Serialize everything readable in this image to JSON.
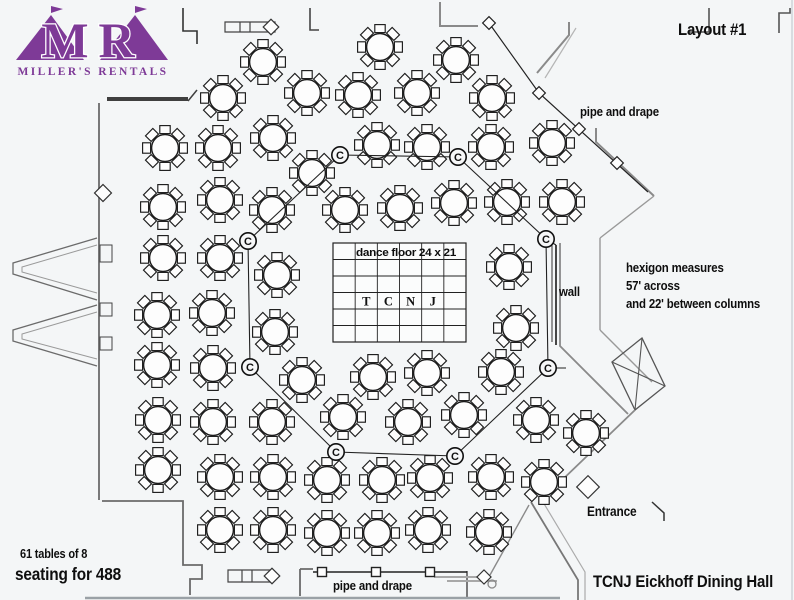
{
  "logo": {
    "monogram": "MR",
    "name": "MILLER'S RENTALS",
    "color": "#7e3a97"
  },
  "labels": {
    "layout_title": "Layout #1",
    "pipe_drape_top": "pipe and drape",
    "pipe_drape_bottom": "pipe and drape",
    "hexagon_note": "hexigon measures\n57' across\nand 22' between columns",
    "wall_label": "wall",
    "entrance_label": "Entrance",
    "tables_note_line1": "61 tables of 8",
    "tables_note_line2": "seating for 488",
    "hall_title": "TCNJ Eickhoff Dining Hall"
  },
  "dance_floor": {
    "label": "dance floor 24 x 21",
    "letters": [
      "T",
      "C",
      "N",
      "J"
    ],
    "x": 333,
    "y": 243,
    "w": 133,
    "h": 99,
    "cols": 6,
    "rows": 6
  },
  "octagon": {
    "marker": "C",
    "vertices": [
      [
        340,
        155
      ],
      [
        458,
        157
      ],
      [
        546,
        239
      ],
      [
        548,
        368
      ],
      [
        455,
        456
      ],
      [
        336,
        452
      ],
      [
        250,
        367
      ],
      [
        248,
        241
      ]
    ],
    "connectors": [
      "M546,239 L556,245",
      "M548,368 H566"
    ]
  },
  "tables": [
    [
      263,
      62
    ],
    [
      380,
      47
    ],
    [
      456,
      60
    ],
    [
      223,
      98
    ],
    [
      307,
      93
    ],
    [
      358,
      95
    ],
    [
      417,
      93
    ],
    [
      492,
      98
    ],
    [
      165,
      148
    ],
    [
      218,
      148
    ],
    [
      273,
      138
    ],
    [
      377,
      145
    ],
    [
      427,
      147
    ],
    [
      491,
      147
    ],
    [
      552,
      143
    ],
    [
      312,
      173
    ],
    [
      163,
      207
    ],
    [
      220,
      200
    ],
    [
      272,
      210
    ],
    [
      345,
      210
    ],
    [
      400,
      208
    ],
    [
      454,
      203
    ],
    [
      507,
      202
    ],
    [
      562,
      202
    ],
    [
      163,
      258
    ],
    [
      220,
      258
    ],
    [
      277,
      275
    ],
    [
      509,
      267
    ],
    [
      157,
      315
    ],
    [
      212,
      313
    ],
    [
      275,
      332
    ],
    [
      516,
      328
    ],
    [
      157,
      365
    ],
    [
      213,
      368
    ],
    [
      302,
      380
    ],
    [
      373,
      377
    ],
    [
      427,
      373
    ],
    [
      501,
      372
    ],
    [
      158,
      420
    ],
    [
      213,
      422
    ],
    [
      272,
      422
    ],
    [
      343,
      417
    ],
    [
      408,
      422
    ],
    [
      464,
      415
    ],
    [
      536,
      420
    ],
    [
      586,
      433
    ],
    [
      158,
      470
    ],
    [
      220,
      477
    ],
    [
      273,
      477
    ],
    [
      327,
      480
    ],
    [
      382,
      480
    ],
    [
      430,
      478
    ],
    [
      491,
      477
    ],
    [
      544,
      482
    ],
    [
      220,
      530
    ],
    [
      273,
      530
    ],
    [
      327,
      533
    ],
    [
      377,
      533
    ],
    [
      428,
      530
    ],
    [
      489,
      532
    ]
  ],
  "pipes": {
    "top_line": [
      [
        489,
        23
      ],
      [
        539,
        93
      ],
      [
        648,
        192
      ]
    ],
    "top_poles": [
      [
        489,
        23
      ],
      [
        539,
        93
      ],
      [
        579,
        129
      ],
      [
        617,
        163
      ]
    ],
    "bottom_line": {
      "y": 572,
      "x1": 313,
      "x2": 467
    },
    "bottom_poles": [
      [
        322,
        572
      ],
      [
        376,
        572
      ],
      [
        430,
        572
      ]
    ]
  },
  "door_diamonds": [
    [
      103,
      193,
      12
    ],
    [
      271,
      27,
      11
    ],
    [
      272,
      576,
      11
    ],
    [
      484,
      577,
      10
    ],
    [
      588,
      487,
      16
    ]
  ],
  "walls": [
    {
      "d": "M107,99 H188",
      "w": 4,
      "c": "#3f3f3f"
    },
    {
      "d": "M188,101 L197,90",
      "w": 1.5,
      "c": "#3f3f3f"
    },
    {
      "d": "M183,8 V31 H197 V44",
      "w": 1.6,
      "c": "#333333"
    },
    {
      "d": "M99,103 V500",
      "w": 1.8,
      "c": "#6b6b6b"
    },
    {
      "d": "M97,238 L13,263 V274 L97,300",
      "w": 1.3,
      "c": "#6b6b6b"
    },
    {
      "d": "M97,245 L22,267 V272 L97,293",
      "w": 1,
      "c": "#9a9a9a"
    },
    {
      "d": "M97,305 L13,330 V341 L97,366",
      "w": 1.3,
      "c": "#6b6b6b"
    },
    {
      "d": "M97,312 L22,334 V339 L97,359",
      "w": 1,
      "c": "#9a9a9a"
    },
    {
      "d": "M100,245 h12 v17 h-12 Z",
      "w": 1,
      "c": "#444444"
    },
    {
      "d": "M100,303 h12 v13 h-12 Z",
      "w": 1,
      "c": "#444444"
    },
    {
      "d": "M100,337 h12 v13 h-12 Z",
      "w": 1,
      "c": "#444444"
    },
    {
      "d": "M102,501 H183 V565 H202 V579 H190 V595",
      "w": 1.8,
      "c": "#6b6b6b"
    },
    {
      "d": "M300,569 V596 M300,569 H313",
      "w": 1.8,
      "c": "#6b6b6b"
    },
    {
      "d": "M467,571 V599",
      "w": 1.8,
      "c": "#6b6b6b"
    },
    {
      "d": "M447,581 H497",
      "w": 2,
      "c": "#a8a8a8"
    },
    {
      "d": "M434,577 H487",
      "w": 2,
      "c": "#a8a8a8"
    },
    {
      "d": "M490,575 L529,505",
      "w": 1.4,
      "c": "#8a8a8a"
    },
    {
      "d": "M531,502 L578,580 V600",
      "w": 1.8,
      "c": "#777777"
    },
    {
      "d": "M540,497 L585,572 V600",
      "w": 1.2,
      "c": "#ababab"
    },
    {
      "d": "M310,8 V30 H319",
      "w": 1.6,
      "c": "#444444"
    },
    {
      "d": "M440,2 V26 H478",
      "w": 2,
      "c": "#8a8a8a"
    },
    {
      "d": "M688,32 H709 V8",
      "w": 1.6,
      "c": "#555555"
    },
    {
      "d": "M790,8 V13 H779 V33",
      "w": 1.6,
      "c": "#555555"
    },
    {
      "d": "M569,22 V35 L537,73",
      "w": 2,
      "c": "#8a8a8a"
    },
    {
      "d": "M576,28 L545,78",
      "w": 1.2,
      "c": "#b5b5b5"
    },
    {
      "d": "M596,128 V142 L654,196",
      "w": 2,
      "c": "#8a8a8a"
    },
    {
      "d": "M654,196 L600,238",
      "w": 1.4,
      "c": "#999999"
    },
    {
      "d": "M600,238 V330",
      "w": 1.4,
      "c": "#999999"
    },
    {
      "d": "M600,330 L652,382",
      "w": 1.4,
      "c": "#999999"
    },
    {
      "d": "M560,243 V346 L628,414",
      "w": 1.8,
      "c": "#8a8a8a"
    },
    {
      "d": "M556,245 V345",
      "w": 1.8,
      "c": "#333333"
    },
    {
      "d": "M552,240 V342",
      "w": 1,
      "c": "#333333"
    },
    {
      "d": "M612,362 L642,338 L665,386 L635,410 Z",
      "w": 1.3,
      "c": "#555555"
    },
    {
      "d": "M612,362 L665,386 M642,338 L635,410",
      "w": 1.1,
      "c": "#555555"
    },
    {
      "d": "M635,410 L560,482",
      "w": 1.8,
      "c": "#8a8a8a"
    },
    {
      "d": "M652,502 L664,513 V521",
      "w": 1.5,
      "c": "#333333"
    },
    {
      "d": "M225,22 H275 V32 H225 Z M240,22 V32 M250,22 V32",
      "w": 1.2,
      "c": "#444444"
    },
    {
      "d": "M228,570 H272 V582 H228 Z M242,570 V582 M252,570 V582",
      "w": 1.2,
      "c": "#444444"
    },
    {
      "d": "M792,0 V600",
      "w": 1.5,
      "c": "#cfd4d8"
    },
    {
      "d": "M85,598 H560",
      "w": 2.5,
      "c": "#9aa1a6"
    }
  ],
  "colors": {
    "line": "#1b1b1b",
    "bg": "#f4f6f7",
    "purple": "#7e3a97"
  },
  "misc": {
    "column_circle": [
      492,
      584,
      4
    ]
  }
}
